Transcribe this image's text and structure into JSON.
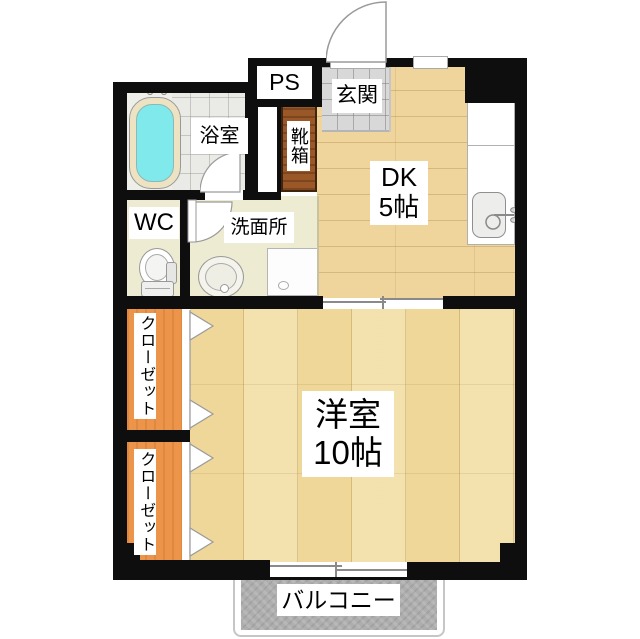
{
  "plan": {
    "title": "apartment-floorplan-1dk",
    "labels": {
      "ps": "PS",
      "genkan": "玄関",
      "bath": "浴室",
      "shoebox": "靴箱",
      "wc": "WC",
      "washroom": "洗面所",
      "dk": "DK",
      "dk_size": "5帖",
      "living": "洋室",
      "living_size": "10帖",
      "closet": "クローゼット",
      "balcony": "バルコニー"
    },
    "colors": {
      "wall": "#0e0e0e",
      "dk_floor": "#efd59c",
      "living_floor": "#f1dda3",
      "wet_area_floor": "#edebd2",
      "bath_tile": "#eaeae6",
      "genkan_tile": "#d8d8d8",
      "closet": "#ec9449",
      "shoebox": "#9a5829",
      "bathtub": "#7fe9eb",
      "balcony": "#aeaeae"
    }
  }
}
